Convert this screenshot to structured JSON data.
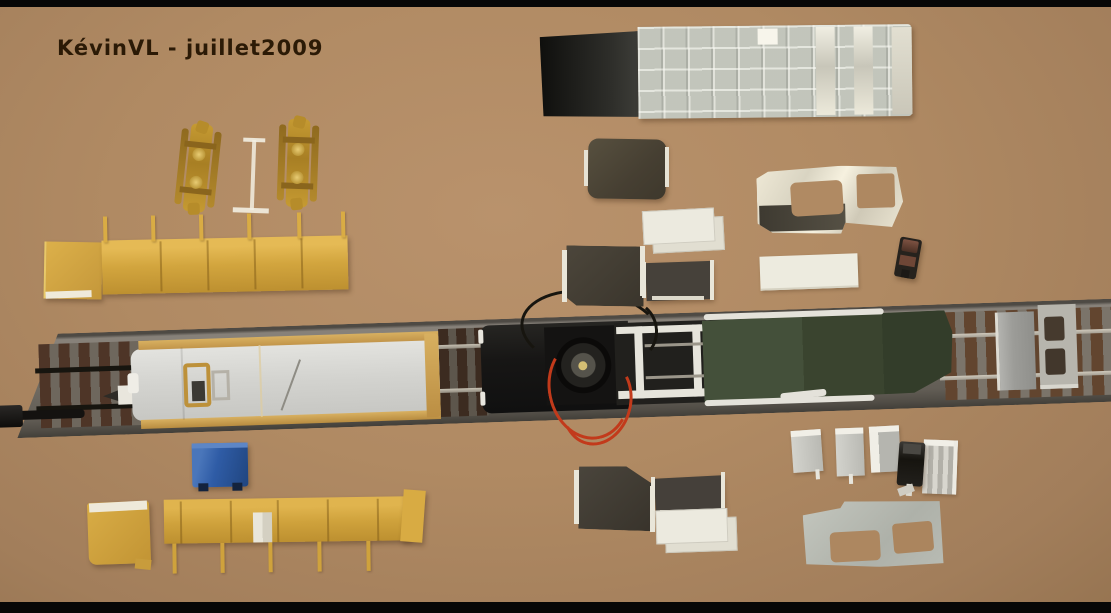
{
  "meta": {
    "type": "photograph",
    "subject": "model railway wagon kit parts laid out on a cardboard workbench, top view"
  },
  "watermark": {
    "text": "KévinVL - juillet2009",
    "color": "#2b1a06"
  },
  "colors": {
    "cardboard": "#b08a63",
    "frame_bars": "#070707",
    "yellow_parts": "#d2a53e",
    "roof_gray": "#b4b8b0",
    "metallic_silver": "#ece9da",
    "dark_styrene": "#46413a",
    "green_deck": "#3a442f",
    "wagon_silver": "#d6d6d2",
    "masking_tape": "#c99f4e",
    "blue_block": "#2f5ca6",
    "red_wire": "#c23a1b",
    "black_wire": "#17150f",
    "brass_bogie": "#c59a32",
    "rail_silver": "#b5afa3",
    "sleeper_brown": "#5a4030"
  },
  "parts": {
    "roof_panel": "roof panel with metallic square tiles",
    "bogies": "two brass bogies",
    "gauge": "white I-shaped gauge mark",
    "fence_top": "yellow barrier strip with posts up",
    "fence_bottom": "yellow barrier strip with posts down",
    "track": "ballasted test track",
    "buffer": "black buffer rod",
    "wagon_floor": "silver wagon floor taped with masking tape",
    "motor": "open-frame motor with red and black wires",
    "lattice": "white styrene underframe lattice",
    "green_deck": "dark green deck panel",
    "foil_cab_side": "silver cab side with window cutouts",
    "gray_cab_side": "gray cab side with window cutouts",
    "blue_block": "blue component block",
    "styrene_offcuts": "dark and white styrene off-cuts",
    "steps": "small gray step brackets",
    "detail_part_red": "small dark detail part with red-brown highlights",
    "detail_part_black": "small black detail part with white pin"
  }
}
